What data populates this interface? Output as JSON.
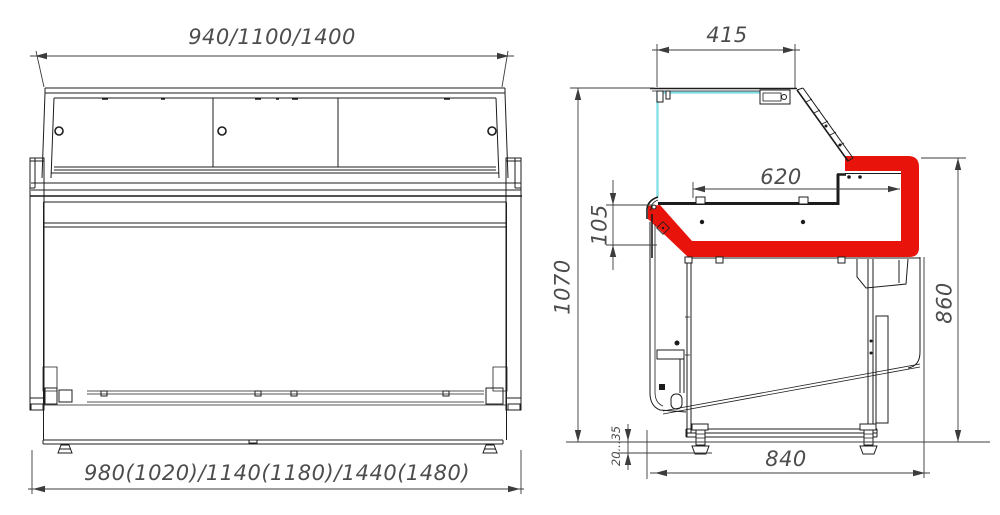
{
  "labels": {
    "front_top_width": "940/1100/1400",
    "front_bottom_width": "980(1020)/1140(1180)/1440(1480)",
    "side_top_depth": "415",
    "side_counter_depth": "620",
    "side_front_height": "105",
    "side_total_height": "1070",
    "side_worktop_height": "860",
    "side_foot_adjust": "20...35",
    "side_base_depth": "840"
  },
  "colors": {
    "line": "#1c1c1c",
    "dim": "#3c3c3c",
    "text": "#4d4d4d",
    "red": "#e8140b",
    "cyan": "#86e0e8",
    "bg": "#ffffff"
  }
}
